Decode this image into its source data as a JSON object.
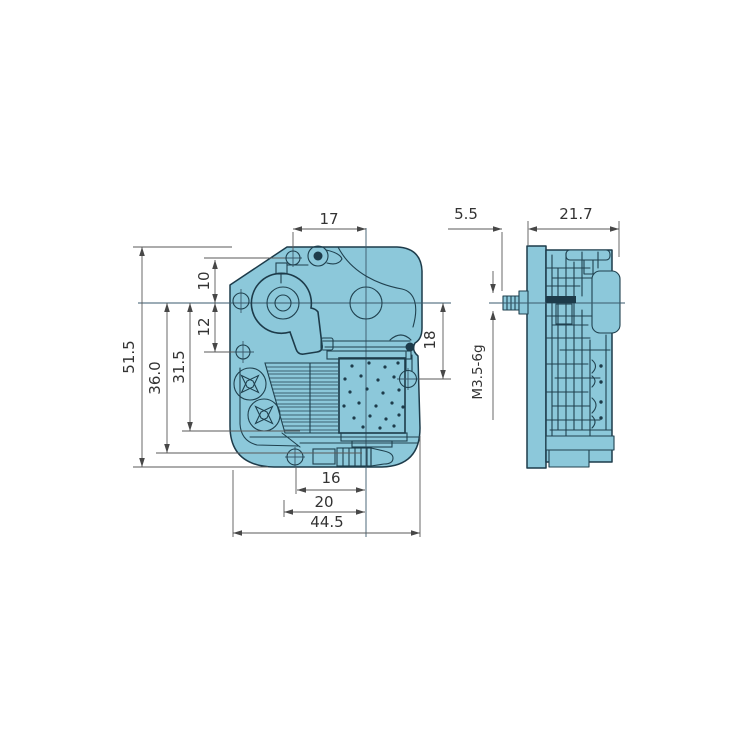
{
  "drawing": {
    "kind": "two-view mechanical dimension drawing",
    "views": {
      "front": {
        "dims": {
          "top_width": "17",
          "overall_height": "51.5",
          "height_36": "36.0",
          "height_31_5": "31.5",
          "offset_12": "12",
          "offset_10": "10",
          "right_offset_18": "18",
          "bottom_16": "16",
          "bottom_20": "20",
          "overall_width": "44.5"
        }
      },
      "side": {
        "dims": {
          "shaft_length": "5.5",
          "depth": "21.7"
        },
        "thread_label": "M3.5-6g"
      }
    },
    "colors": {
      "body_fill": "#8cc8da",
      "outline": "#1d3b4a",
      "dimension_line": "#5a5a5a",
      "dimension_text": "#333333",
      "background": "#ffffff"
    }
  }
}
